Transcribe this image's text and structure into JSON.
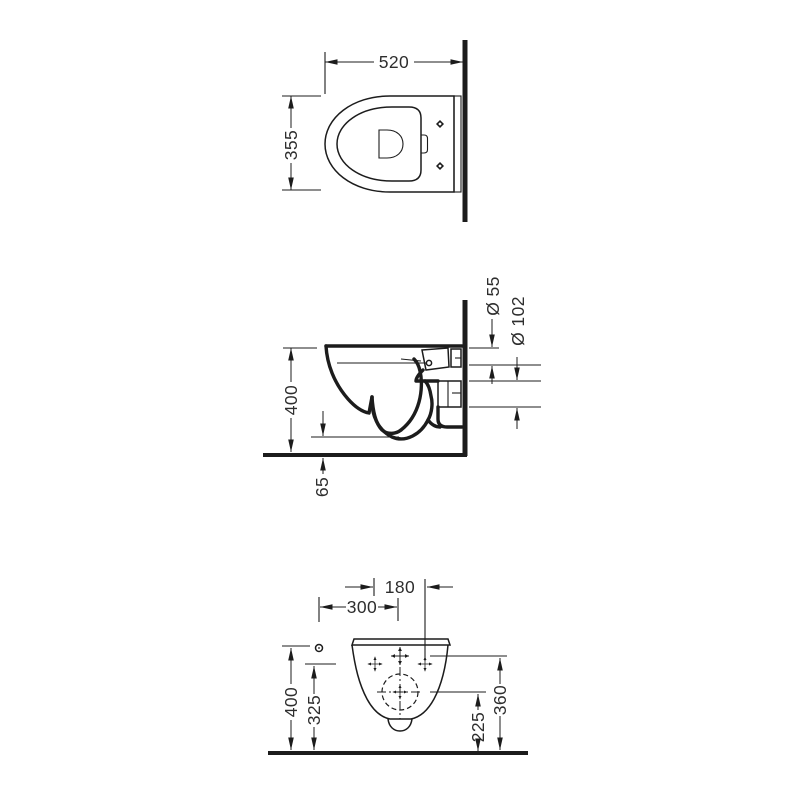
{
  "page": {
    "background_color": "#ffffff",
    "line_color": "#1c1c1c",
    "text_color": "#2e2e2e",
    "description": "Technical dimension drawing of a wall-hung toilet, three orthographic views"
  },
  "views": {
    "top": {
      "width": "520",
      "depth": "355"
    },
    "side": {
      "height": "400",
      "floor_clearance": "65",
      "inlet_diameter": "Ø 55",
      "outlet_diameter": "Ø 102"
    },
    "front": {
      "fixing_hole_spacing": "180",
      "side_fixing_distance": "300",
      "height": "400",
      "fixing_hole_height": "325",
      "outlet_center_height": "225",
      "inlet_center_height": "360"
    }
  }
}
